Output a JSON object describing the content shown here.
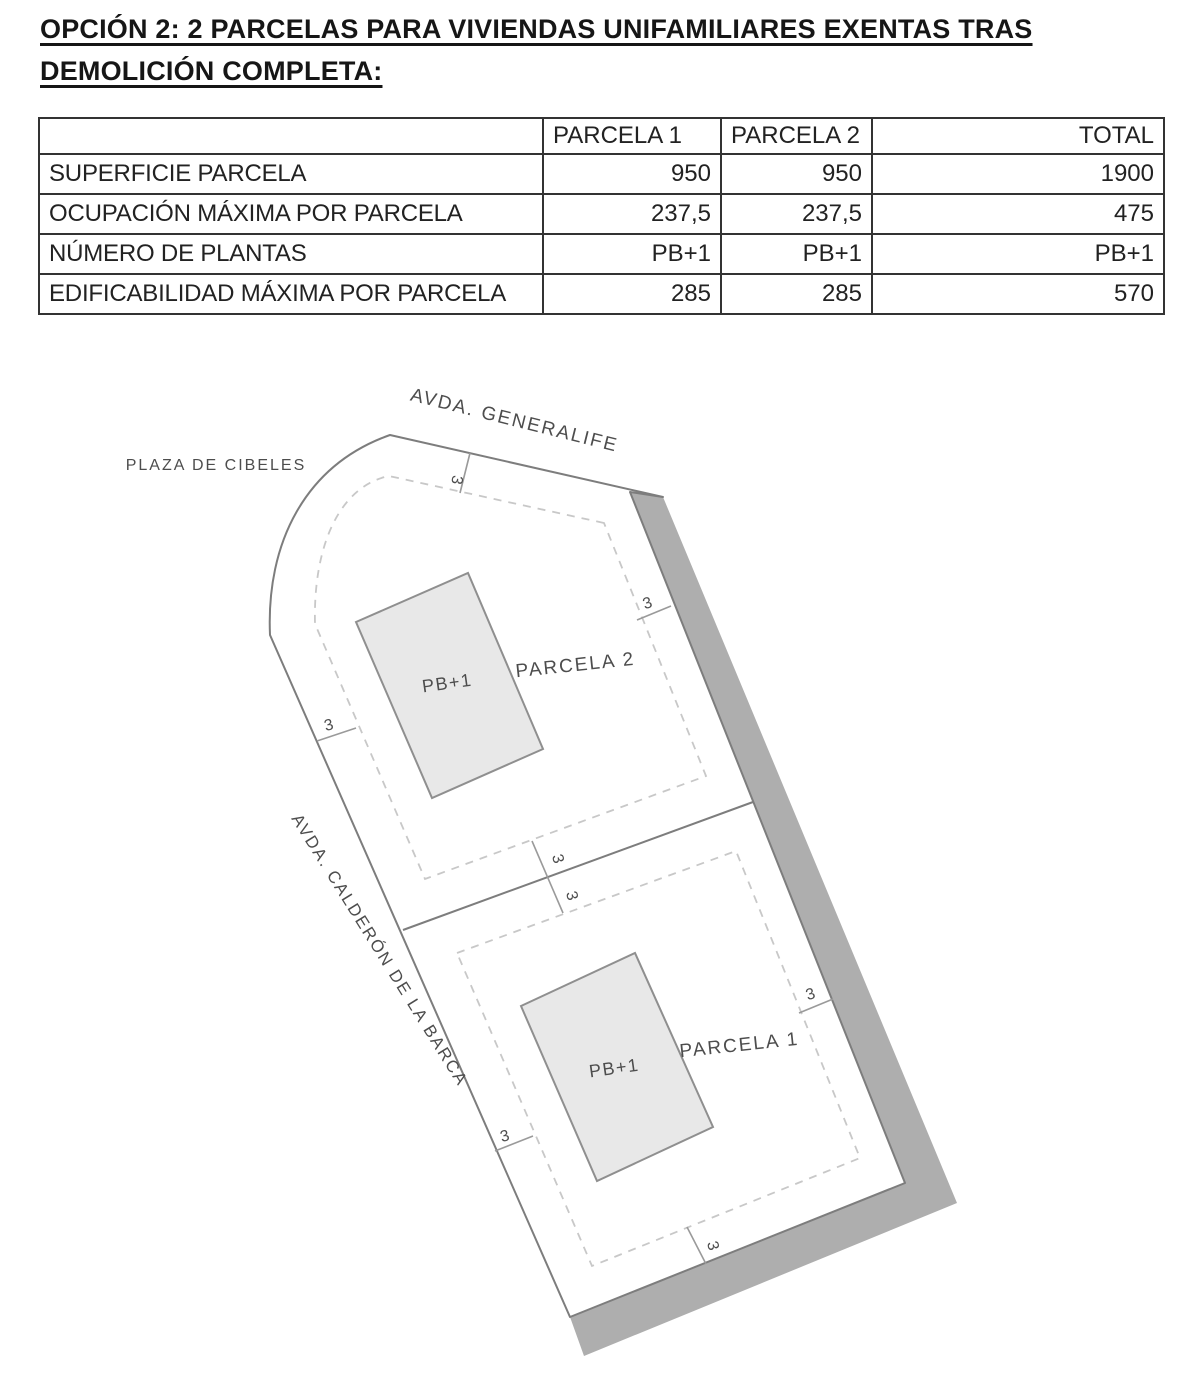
{
  "title": {
    "line1": "OPCIÓN 2: 2 PARCELAS PARA VIVIENDAS UNIFAMILIARES EXENTAS TRAS",
    "line2": "DEMOLICIÓN COMPLETA:"
  },
  "table": {
    "header": [
      "",
      "PARCELA 1",
      "PARCELA 2",
      "TOTAL"
    ],
    "rows": [
      [
        "SUPERFICIE PARCELA",
        "950",
        "950",
        "1900"
      ],
      [
        "OCUPACIÓN MÁXIMA POR PARCELA",
        "237,5",
        "237,5",
        "475"
      ],
      [
        "NÚMERO DE PLANTAS",
        "PB+1",
        "PB+1",
        "PB+1"
      ],
      [
        "EDIFICABILIDAD MÁXIMA POR PARCELA",
        "285",
        "285",
        "570"
      ]
    ]
  },
  "plan": {
    "street_top": "AVDA. GENERALIFE",
    "plaza": "PLAZA DE CIBELES",
    "street_left": "AVDA. CALDERÓN DE LA BARCA",
    "parcel2": "PARCELA 2",
    "parcel1": "PARCELA 1",
    "building": "PB+1",
    "setback": "3",
    "colors": {
      "band": "#aeaeae",
      "building_fill": "#e8e8e8",
      "boundary_line": "#7d7d7d",
      "dashed_line": "#c8c8c8"
    }
  }
}
